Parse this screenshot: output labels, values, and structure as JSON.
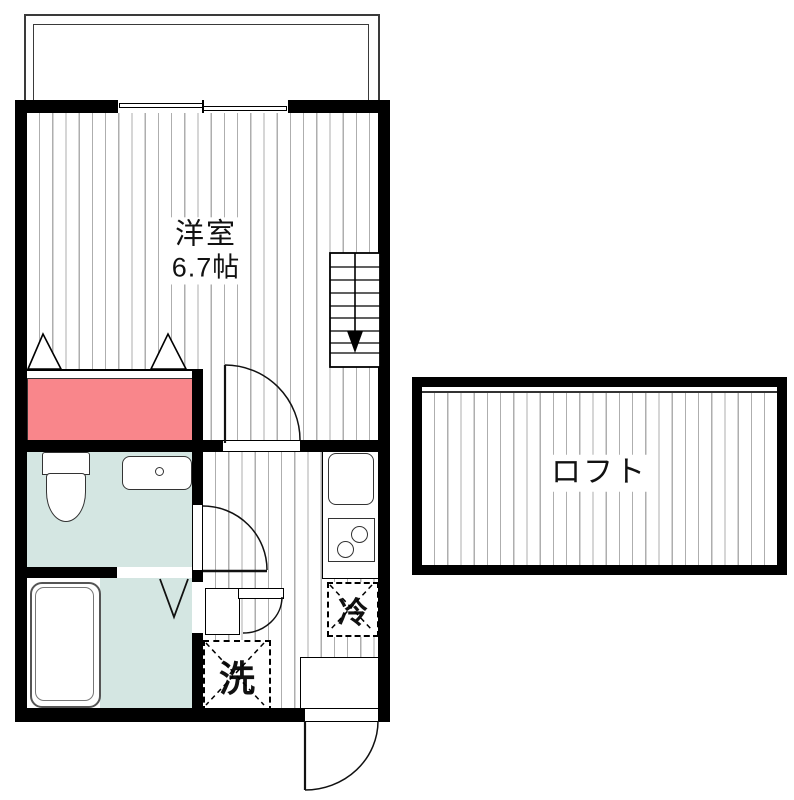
{
  "floorplan": {
    "main_room": {
      "label": "洋室",
      "size": "6.7帖"
    },
    "loft": {
      "label": "ロフト"
    },
    "appliances": {
      "fridge_label": "冷",
      "washer_label": "洗"
    }
  },
  "colors": {
    "wall": "#000000",
    "closet-pink": "#f9868b",
    "wet-area-mint": "#d4e6e2",
    "hatch-gray": "#aeaeae"
  }
}
